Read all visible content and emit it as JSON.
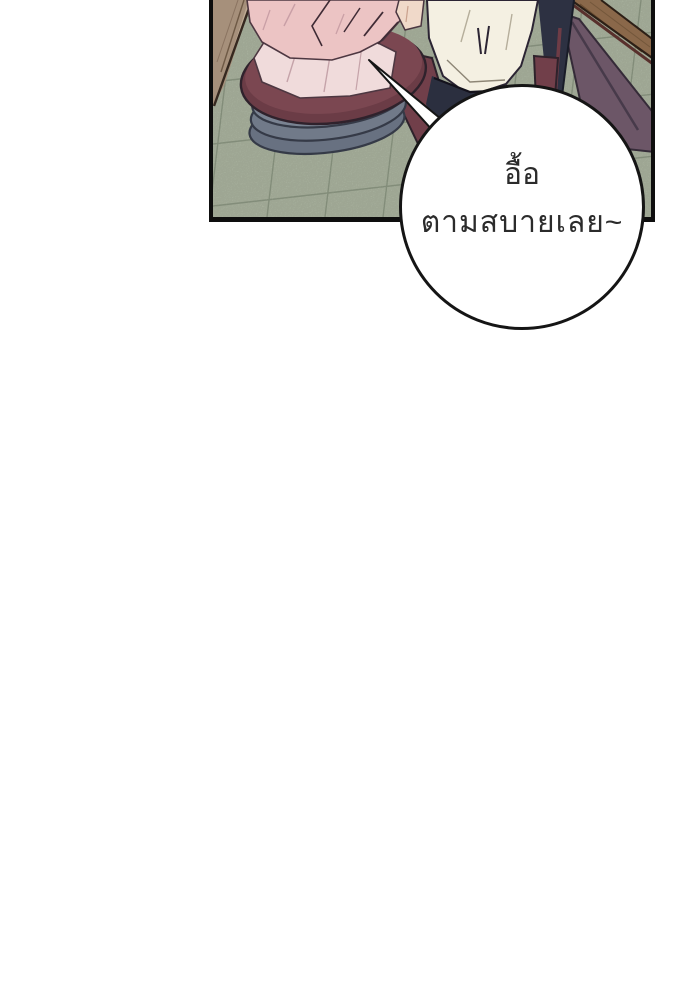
{
  "page": {
    "background_color": "#ffffff"
  },
  "panel": {
    "border_color": "#0e0e0e",
    "floor_tile_color": "#b9c3ad",
    "tile_line_color": "#95a18b",
    "wood_plank_color": "#a6907b",
    "table_wood_color": "#8a684a",
    "table_side_color": "#6c5667",
    "seat_cushion_color": "#7b4751",
    "cushion_stack_color": "#7a8392",
    "left_person_shirt_color": "#ecc4c4",
    "right_person_shirt_color": "#f4f0e2",
    "right_person_pants_color": "#2b2f3f",
    "skin_color": "#f0d9c9"
  },
  "speech_bubble": {
    "fill_color": "#ffffff",
    "border_color": "#151515",
    "text_color": "#2b2b2b",
    "line1": "อื้อ",
    "line2": "ตามสบายเลย~"
  },
  "scene": {
    "description_labels": [
      "tiled-floor",
      "wood-plank",
      "dining-table-edge",
      "table-side-panel",
      "cushion-stack",
      "left-person-pink-shirt",
      "right-person-white-shirt",
      "right-person-pants",
      "speech-bubble"
    ]
  }
}
